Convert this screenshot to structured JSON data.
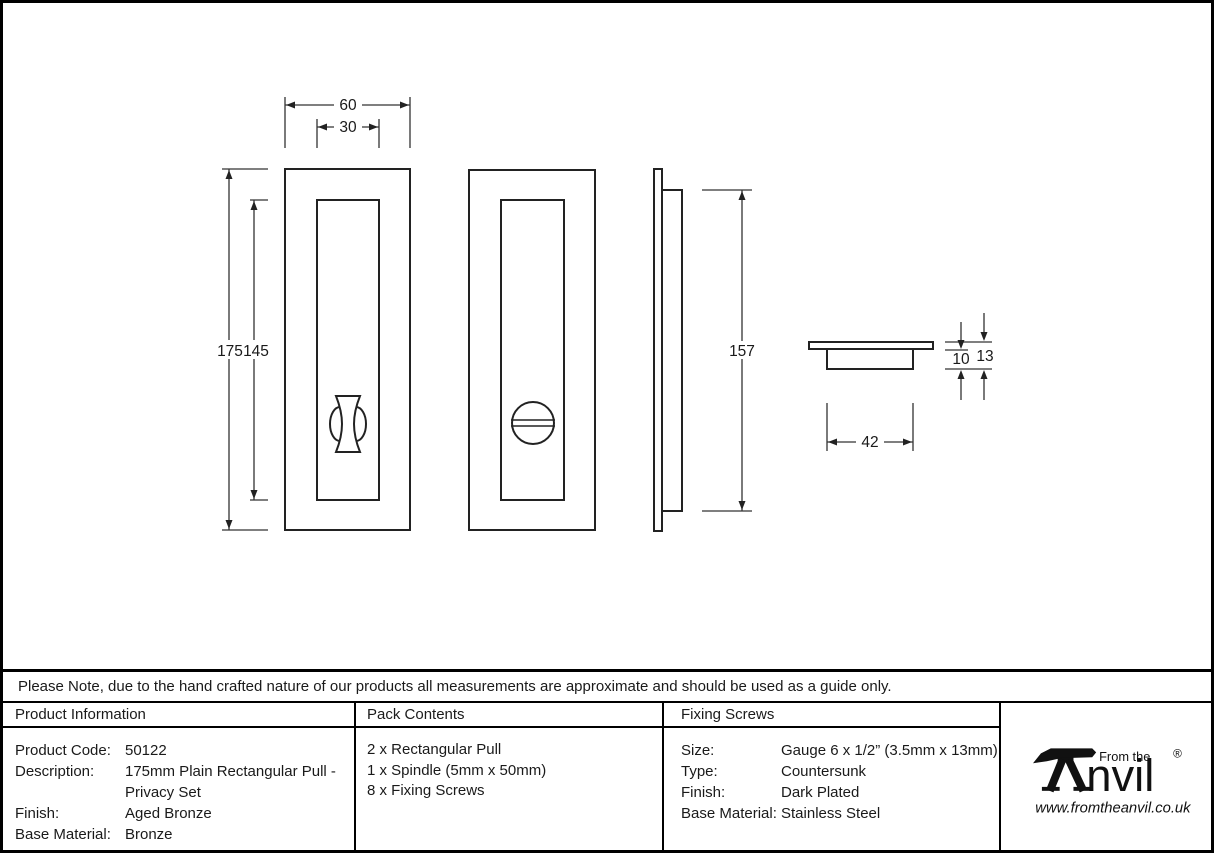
{
  "drawing": {
    "dims": {
      "width_outer": "60",
      "width_inner": "30",
      "height_outer": "175",
      "height_inner": "145",
      "side_height": "157",
      "cup_width": "42",
      "cup_depth": "10",
      "total_depth": "13"
    }
  },
  "note": "Please Note, due to the hand crafted nature of our products all measurements are approximate and should be used as a guide only.",
  "table": {
    "product_info": {
      "header": "Product Information",
      "rows": [
        {
          "label": "Product Code:",
          "value": "50122"
        },
        {
          "label": "Description:",
          "value": "175mm Plain Rectangular Pull -"
        },
        {
          "label": "",
          "value": "Privacy Set"
        },
        {
          "label": "Finish:",
          "value": "Aged Bronze"
        },
        {
          "label": "Base Material:",
          "value": "Bronze"
        }
      ]
    },
    "pack_contents": {
      "header": "Pack Contents",
      "items": [
        "2 x Rectangular Pull",
        "1 x Spindle (5mm x 50mm)",
        "8 x Fixing Screws"
      ]
    },
    "fixing_screws": {
      "header": "Fixing Screws",
      "rows": [
        {
          "label": "Size:",
          "value": "Gauge 6 x 1/2” (3.5mm x 13mm)"
        },
        {
          "label": "Type:",
          "value": "Countersunk"
        },
        {
          "label": "Finish:",
          "value": "Dark Plated"
        },
        {
          "label": "Base Material:",
          "value": "Stainless Steel"
        }
      ]
    }
  },
  "logo": {
    "from_the": "From the",
    "brand_rest": "nvil",
    "registered": "®",
    "url": "www.fromtheanvil.co.uk"
  }
}
